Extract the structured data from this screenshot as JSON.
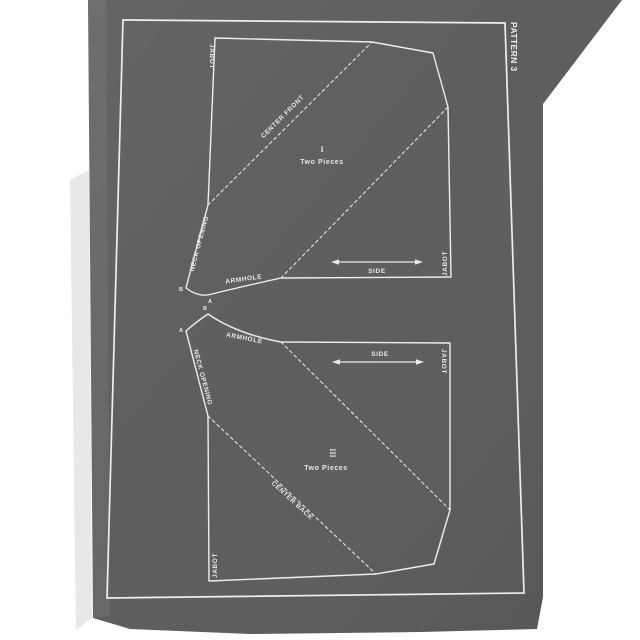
{
  "plate": {
    "pattern_label": "PATTERN 3"
  },
  "pieces": {
    "front": {
      "numeral": "I",
      "pieces_count": "Two Pieces",
      "jabot_top_left": "JABOT",
      "jabot_bottom_right": "JABOT",
      "center_line": "CENTER FRONT",
      "neck_opening": "NECK OPENING",
      "armhole": "ARMHOLE",
      "side": "SIDE",
      "point_a": "A",
      "point_b": "B"
    },
    "back": {
      "numeral": "III",
      "pieces_count": "Two Pieces",
      "jabot_top_right": "JABOT",
      "jabot_bottom_left": "JABOT",
      "center_line": "CENTER BACK",
      "neck_opening": "NECK OPENING",
      "armhole": "ARMHOLE",
      "side": "SIDE",
      "point_a": "A",
      "point_b": "B"
    }
  },
  "colors": {
    "backdrop": "#ffffff",
    "plate": "#5b5b5b",
    "ink": "#eeeeee",
    "edge_shadow": "#d6d6d6"
  }
}
